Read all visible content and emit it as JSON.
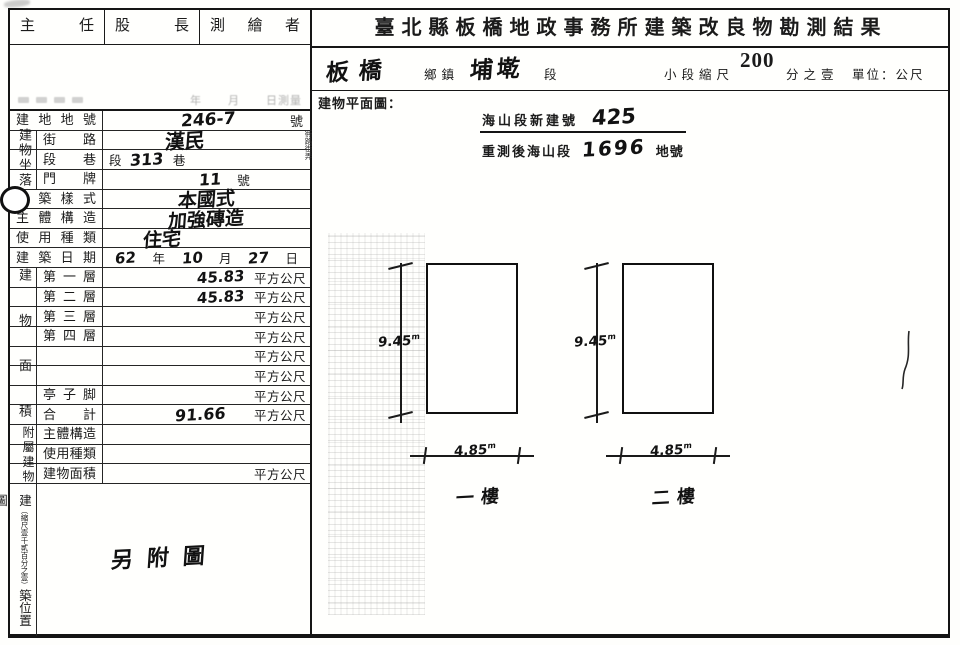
{
  "officials": {
    "chief": "主任",
    "section_chief": "股長",
    "surveyor": "測繪者"
  },
  "survey_date_row": {
    "labels": [
      "年",
      "月",
      "日測量"
    ]
  },
  "form": {
    "lot": {
      "label": "建地地號",
      "value": "246-7",
      "suffix": "號"
    },
    "location": {
      "group_label": "建物坐落",
      "street": {
        "label": "街路",
        "value": "漢民",
        "side_note": "衖路街弄"
      },
      "lane": {
        "label": "段巷",
        "pre": "段",
        "value": "313",
        "post": "巷"
      },
      "plate": {
        "label": "門牌",
        "value": "11",
        "suffix": "號"
      }
    },
    "style": {
      "label": "建築樣式",
      "value": "本國式"
    },
    "structure": {
      "label": "主體構造",
      "value": "加強磚造"
    },
    "usage": {
      "label": "使用種類",
      "value": "住宅"
    },
    "built_date": {
      "label": "建築日期",
      "year": "62",
      "year_unit": "年",
      "month": "10",
      "month_unit": "月",
      "day": "27",
      "day_unit": "日"
    },
    "area": {
      "group_label": "建物面積",
      "unit": "平方公尺",
      "rows": [
        {
          "label": "第一層",
          "value": "45.83"
        },
        {
          "label": "第二層",
          "value": "45.83"
        },
        {
          "label": "第三層",
          "value": ""
        },
        {
          "label": "第四層",
          "value": ""
        },
        {
          "label": "",
          "value": ""
        },
        {
          "label": "",
          "value": ""
        },
        {
          "label": "亭子脚",
          "value": ""
        },
        {
          "label": "合計",
          "value": "91.66"
        }
      ]
    },
    "annex": {
      "group_label": "附屬建物",
      "rows": [
        {
          "label": "主體構造",
          "value": ""
        },
        {
          "label": "使用種類",
          "value": ""
        },
        {
          "label": "建物面積",
          "value": "",
          "unit": "平方公尺"
        }
      ]
    },
    "site_map": {
      "label_first": "建",
      "scale_note": "（縮尺壹千貳百分之壹）",
      "label_rest": "築位置圖",
      "handwritten": "另附圖"
    }
  },
  "header": {
    "title": "臺北縣板橋地政事務所建築改良物勘測結果",
    "township_value": "板橋",
    "township_label": "鄉鎮",
    "section_value": "埔墘",
    "section_label": "段",
    "scale_label": "小段縮尺",
    "scale_value": "200",
    "scale_suffix": "分之壹",
    "unit_label": "單位：公尺"
  },
  "plan": {
    "label": "建物平面圖：",
    "stamp": {
      "line1_label": "海山段新建號",
      "line1_value": "425",
      "line2_label": "重測後海山段",
      "line2_value": "1696",
      "line2_suffix": "地號"
    },
    "dim_unit": "m",
    "floors": [
      {
        "name": "一樓",
        "height": "9.45",
        "width": "4.85"
      },
      {
        "name": "二樓",
        "height": "9.45",
        "width": "4.85"
      }
    ]
  }
}
